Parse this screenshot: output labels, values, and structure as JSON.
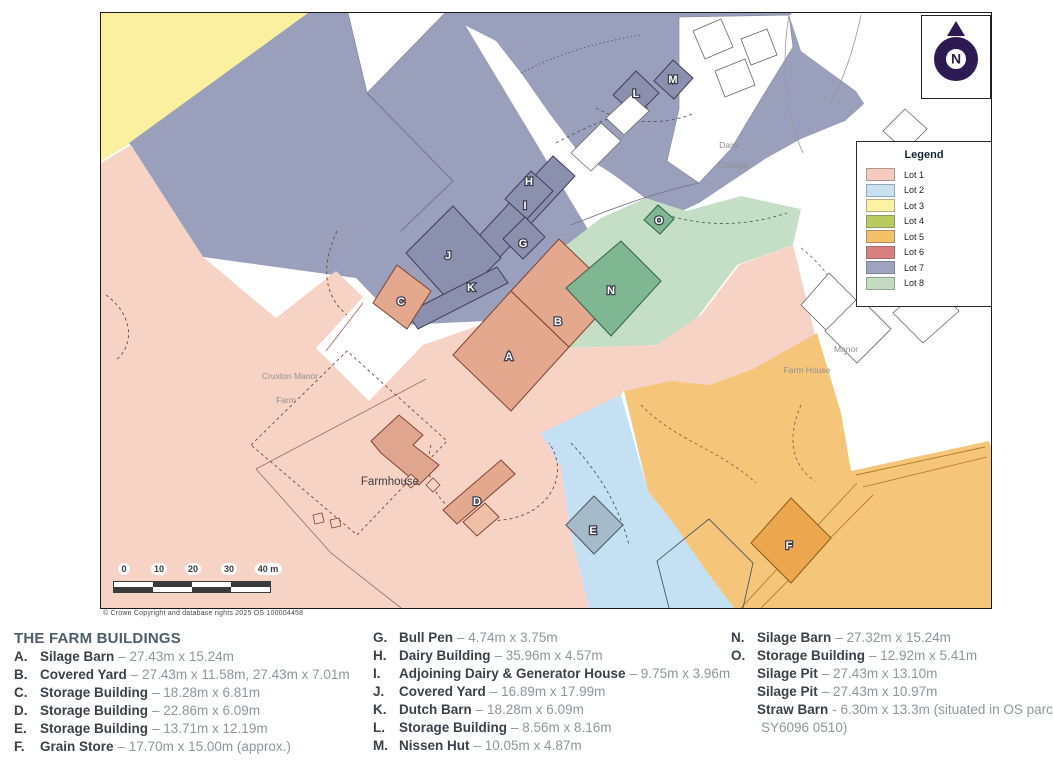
{
  "map": {
    "copyright": "© Crown Copyright and database rights 2025 OS 100004458",
    "north_label": "N",
    "scale_ticks": [
      "0",
      "10",
      "20",
      "30",
      "40 m"
    ],
    "place_labels": {
      "cruxton_manor": "Cruxton Manor",
      "farm": "Farm",
      "farmhouse": "Farmhouse",
      "dairy": "Dairy",
      "cottage": "Cottage",
      "manor": "Manor",
      "farm_house": "Farm House"
    },
    "building_letters": {
      "a": "A",
      "b": "B",
      "c": "C",
      "d": "D",
      "e": "E",
      "f": "F",
      "g": "G",
      "h": "H",
      "i": "I",
      "j": "J",
      "k": "K",
      "l": "L",
      "m": "M",
      "n": "N",
      "o": "O"
    }
  },
  "legend": {
    "title": "Legend",
    "items": [
      {
        "label": "Lot 1",
        "color": "#f4cbbc"
      },
      {
        "label": "Lot 2",
        "color": "#c9e2f2"
      },
      {
        "label": "Lot 3",
        "color": "#fbf3a3"
      },
      {
        "label": "Lot 4",
        "color": "#b9ca5e"
      },
      {
        "label": "Lot 5",
        "color": "#f4c06a"
      },
      {
        "label": "Lot 6",
        "color": "#d88080"
      },
      {
        "label": "Lot 7",
        "color": "#a0a3bd"
      },
      {
        "label": "Lot 8",
        "color": "#c3dcc1"
      }
    ]
  },
  "buildings": {
    "heading": "THE FARM BUILDINGS",
    "column1": [
      {
        "letter": "A.",
        "name": "Silage Barn",
        "detail": "– 27.43m x 15.24m"
      },
      {
        "letter": "B.",
        "name": "Covered Yard",
        "detail": "– 27.43m x 11.58m, 27.43m x 7.01m"
      },
      {
        "letter": "C.",
        "name": "Storage Building",
        "detail": "– 18.28m x 6.81m"
      },
      {
        "letter": "D.",
        "name": "Storage Building",
        "detail": "– 22.86m x 6.09m"
      },
      {
        "letter": "E.",
        "name": "Storage Building",
        "detail": "– 13.71m x 12.19m"
      },
      {
        "letter": "F.",
        "name": "Grain Store",
        "detail": "– 17.70m x 15.00m (approx.)"
      }
    ],
    "column2": [
      {
        "letter": "G.",
        "name": "Bull Pen",
        "detail": "– 4.74m x 3.75m"
      },
      {
        "letter": "H.",
        "name": "Dairy Building",
        "detail": "– 35.96m x 4.57m"
      },
      {
        "letter": "I.",
        "name": "Adjoining Dairy & Generator House",
        "detail": "– 9.75m x 3.96m"
      },
      {
        "letter": "J.",
        "name": "Covered Yard",
        "detail": "– 16.89m x 17.99m"
      },
      {
        "letter": "K.",
        "name": "Dutch Barn",
        "detail": "– 18.28m x 6.09m"
      },
      {
        "letter": "L.",
        "name": "Storage Building",
        "detail": "– 8.56m x 8.16m"
      },
      {
        "letter": "M.",
        "name": "Nissen Hut",
        "detail": "– 10.05m x 4.87m"
      }
    ],
    "column3": [
      {
        "letter": "N.",
        "name": "Silage Barn",
        "detail": "– 27.32m x 15.24m"
      },
      {
        "letter": "O.",
        "name": "Storage Building",
        "detail": "– 12.92m x 5.41m"
      },
      {
        "letter": "",
        "name": "Silage Pit",
        "detail": "– 27.43m x 13.10m"
      },
      {
        "letter": "",
        "name": "Silage Pit",
        "detail": "– 27.43m x 10.97m"
      },
      {
        "letter": "",
        "name": "Straw Barn",
        "detail": "- 6.30m x 13.3m (situated in OS parcel"
      },
      {
        "letter": "",
        "name": "",
        "detail": "SY6096 0510)"
      }
    ]
  },
  "colors": {
    "lot1_base": "#f7d3c6",
    "lot1_building": "#e4a88f",
    "lot2_base": "#c3e1f3",
    "lot2_building": "#a5bbca",
    "lot3_base": "#faf0a0",
    "lot5_base": "#f5c57a",
    "lot5_building": "#eca64d",
    "lot7_base": "#9aa0bb",
    "lot7_building": "#8b90ae",
    "lot8_base": "#c5dfc6",
    "lot8_building": "#7fb793",
    "north_arrow": "#2d1a52"
  }
}
